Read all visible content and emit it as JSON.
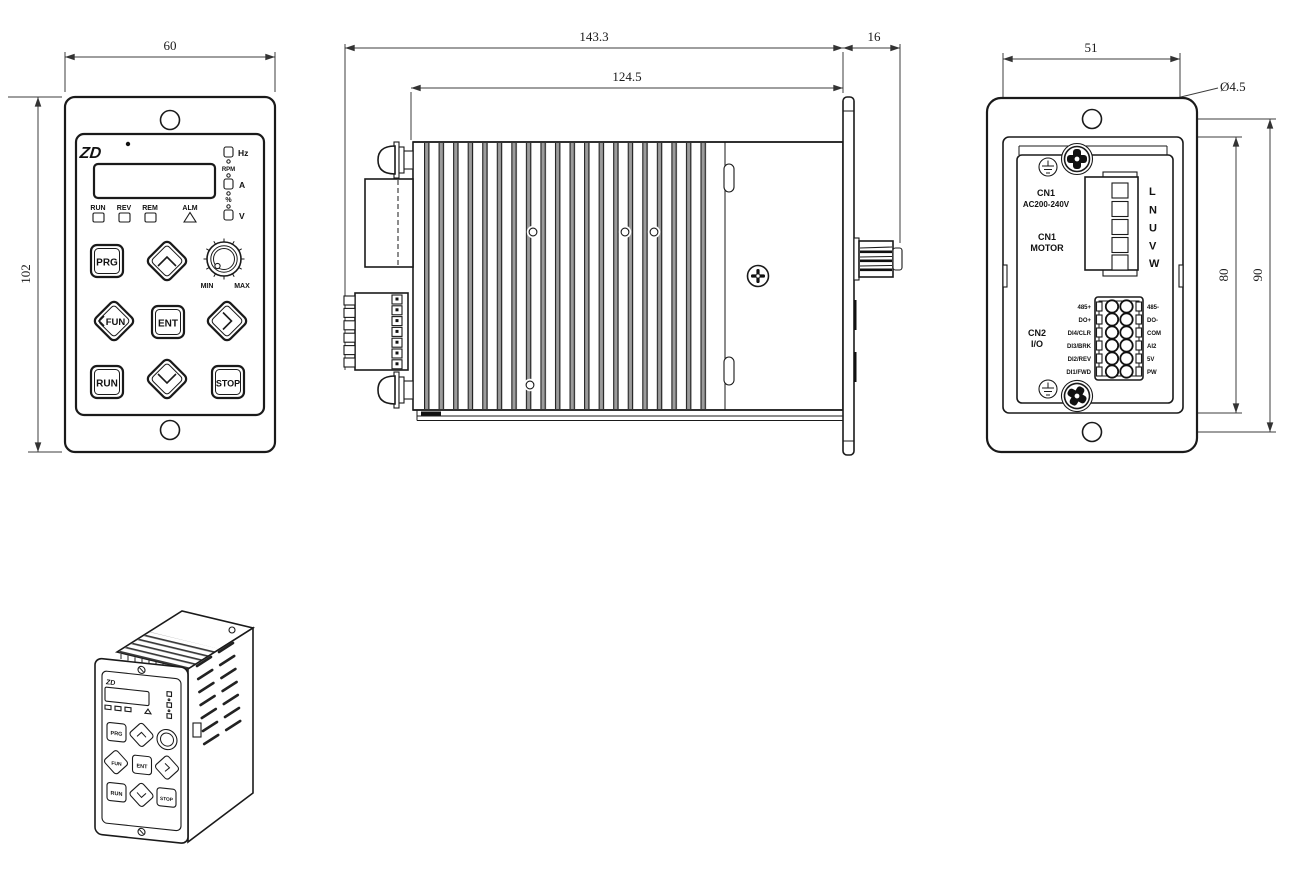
{
  "front_view": {
    "dim_width": "60",
    "dim_height": "102",
    "logo": "ZD",
    "units": {
      "hz": "Hz",
      "rpm": "RPM",
      "amp": "A",
      "percent": "%",
      "volt": "V"
    },
    "leds": {
      "run": "RUN",
      "rev": "REV",
      "rem": "REM",
      "alm": "ALM"
    },
    "keys": {
      "prg": "PRG",
      "fun": "FUN",
      "ent": "ENT",
      "run": "RUN",
      "stop": "STOP"
    },
    "knob_min": "MIN",
    "knob_max": "MAX"
  },
  "side_view": {
    "dim_overall": "143.3",
    "dim_body": "124.5",
    "dim_front": "16"
  },
  "back_view": {
    "dim_width": "51",
    "hole_dia": "Ø4.5",
    "dim_cutout": "80",
    "dim_holes": "90",
    "cn1_power_1": "CN1",
    "cn1_power_2": "AC200-240V",
    "cn1_motor_1": "CN1",
    "cn1_motor_2": "MOTOR",
    "cn2_1": "CN2",
    "cn2_2": "I/O",
    "power_terminals": [
      "L",
      "N",
      "U",
      "V",
      "W"
    ],
    "io_left": [
      "485+",
      "DO+",
      "DI4/CLR",
      "DI3/BRK",
      "DI2/REV",
      "DI1/FWD"
    ],
    "io_right": [
      "485-",
      "DO-",
      "COM",
      "AI2",
      "5V",
      "PW"
    ]
  }
}
